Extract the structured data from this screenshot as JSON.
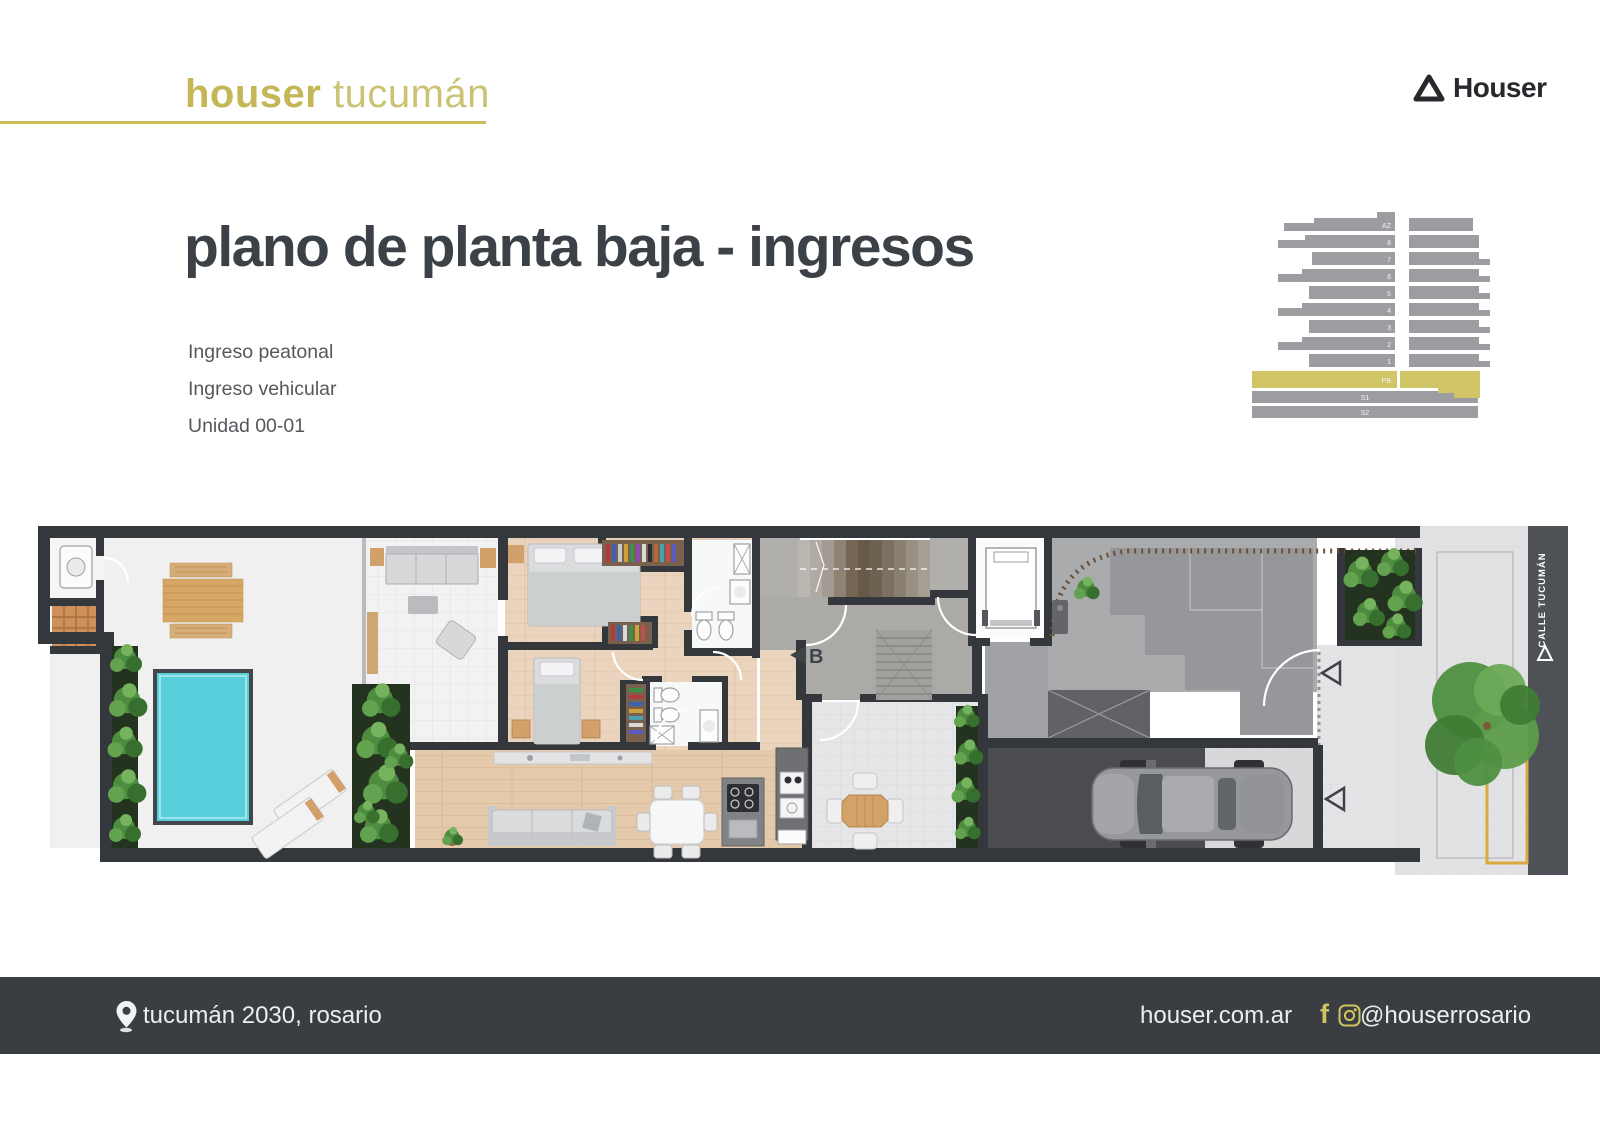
{
  "header": {
    "brand_bold": "houser",
    "brand_light": "tucumán",
    "logo_text": "Houser"
  },
  "title": "plano de planta baja - ingresos",
  "legend": {
    "items": [
      "Ingreso peatonal",
      "Ingreso vehicular",
      "Unidad 00-01"
    ]
  },
  "elevation": {
    "floors": [
      "AZ",
      "8",
      "7",
      "6",
      "5",
      "4",
      "3",
      "2",
      "1"
    ],
    "ground": "PB",
    "basement1": "S1",
    "basement2": "S2"
  },
  "plan": {
    "section_marker": "B",
    "street_label": "CALLE TUCUMÁN"
  },
  "footer": {
    "address": "tucumán 2030, rosario",
    "website": "houser.com.ar",
    "social_handle": "@houserrosario"
  },
  "colors": {
    "accent_gold": "#c9bd5c",
    "elevation_highlight": "#d2c566",
    "pool_cyan": "#57cfdb",
    "wall_dark": "#34373b",
    "footer_bg": "#3a3e43"
  }
}
